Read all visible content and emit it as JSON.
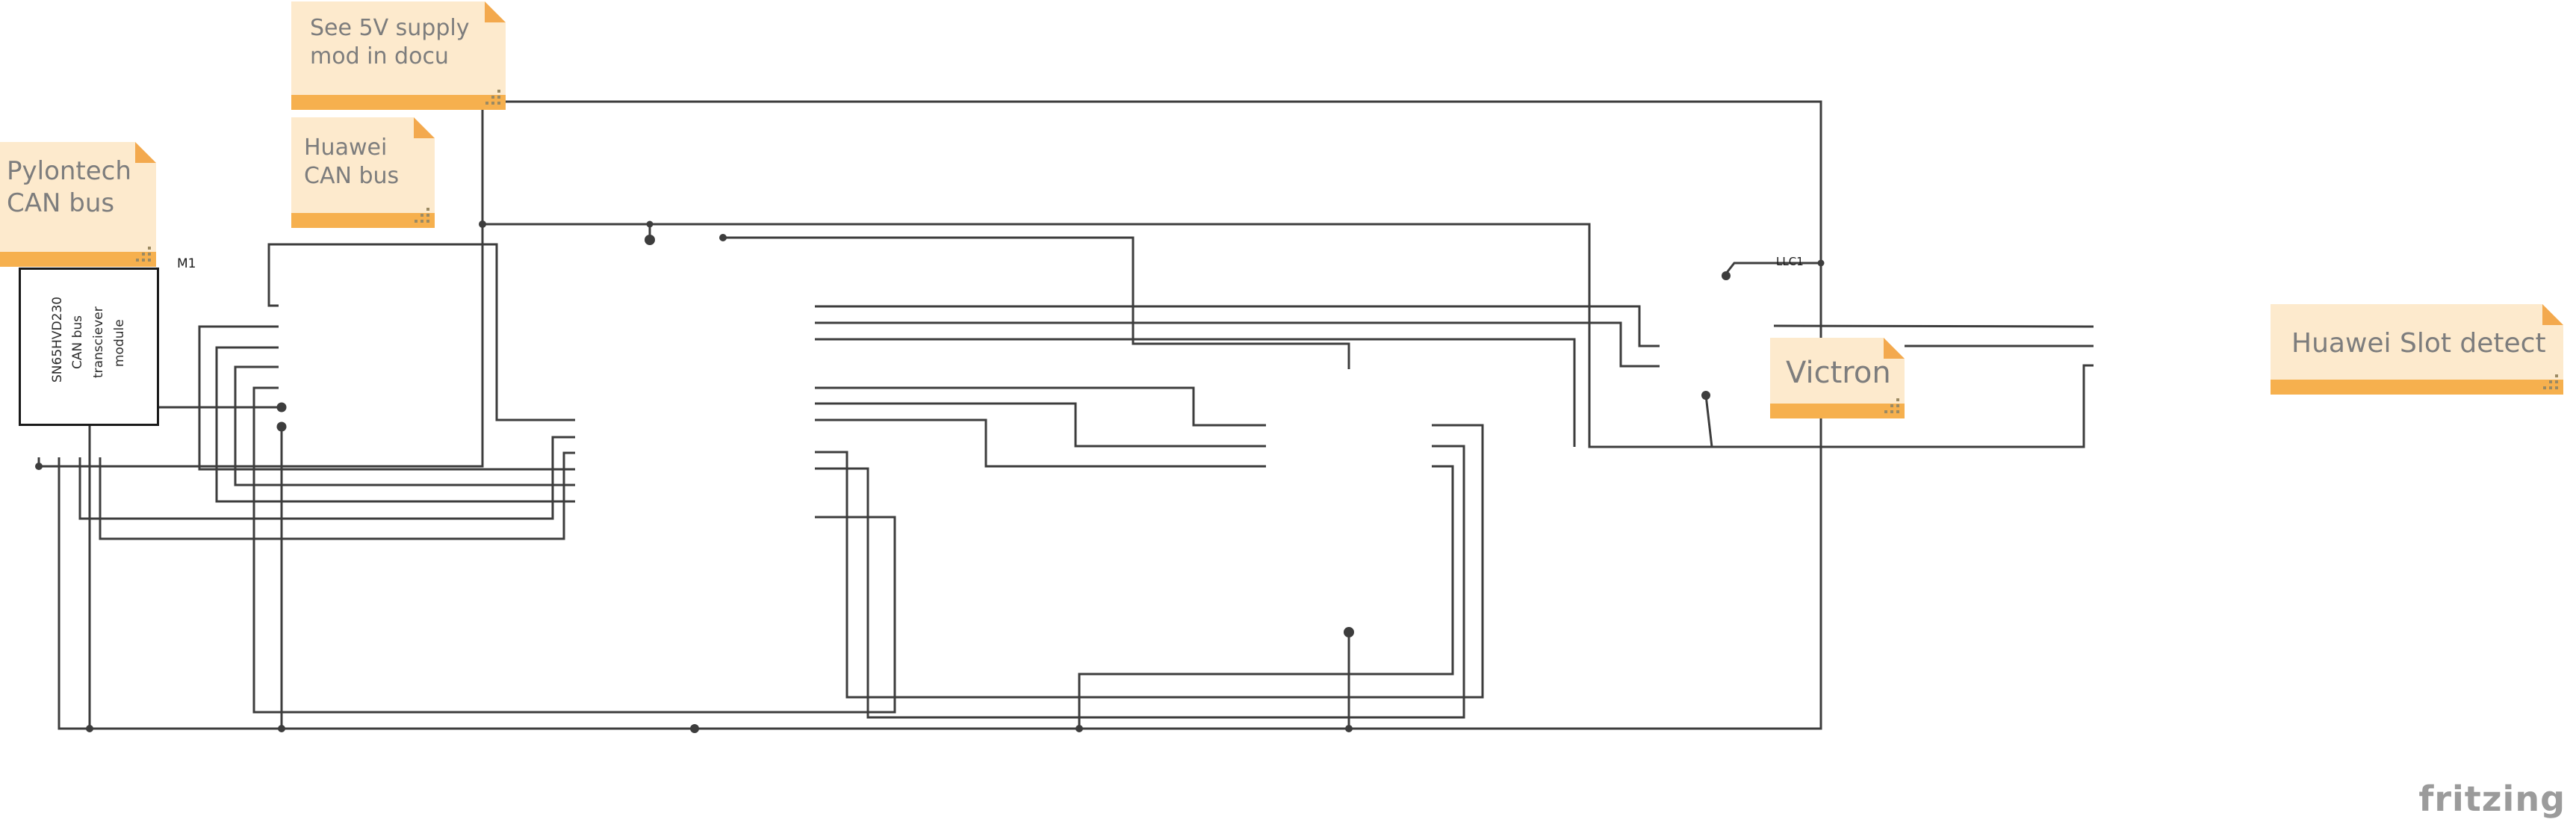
{
  "watermark": "fritzing",
  "colors": {
    "wire": "#3d3d3d",
    "pin_green": "#2db82d",
    "pin_green_glow": "#9fe49f",
    "pin_red": "#c03030",
    "pin_red_glow": "#f0a8a8",
    "note_body": "#fdeacd",
    "note_bar": "#f6b04e",
    "note_text": "#7d7d7d"
  },
  "notes": {
    "see5v": {
      "lines": [
        "See 5V supply",
        "mod in docu"
      ]
    },
    "pylontech": {
      "lines": [
        "Pylontech",
        "CAN bus"
      ]
    },
    "huawei_can": {
      "lines": [
        "Huawei",
        "CAN bus"
      ]
    },
    "victron": {
      "lines": [
        "Victron"
      ]
    },
    "huawei_slot": {
      "lines": [
        "Huawei Slot detect"
      ]
    }
  },
  "wire_labels": {
    "llc1_net": "LLC1"
  },
  "modules": {
    "m1": {
      "designator": "M1",
      "body_lines": [
        "SN65HVD230",
        "CAN bus",
        "transciever",
        "module"
      ],
      "bottom_pins": [
        {
          "n": "1",
          "label": "3V3",
          "color": "green"
        },
        {
          "n": "2",
          "label": "GND",
          "color": "green"
        },
        {
          "n": "3",
          "label": "CTX",
          "color": "green"
        },
        {
          "n": "4",
          "label": "CRX",
          "color": "green"
        },
        {
          "n": "5",
          "label": "CANH",
          "color": "red"
        },
        {
          "n": "6",
          "label": "CANL",
          "color": "red"
        }
      ]
    },
    "m2": {
      "designator": "M2",
      "vendor_lines": [
        "Niren",
        "MCP2515_CAN",
        "Module"
      ],
      "termination_lines": [
        "120 ohm",
        "termination"
      ],
      "jumpers": [
        "J1",
        "J2",
        "J4",
        "J3"
      ],
      "left_pins": [
        "INT",
        "SCK",
        "SI",
        "SO",
        "CS",
        "GND",
        "VCC"
      ],
      "right_pins": [
        "CAN H",
        "CAN L",
        "CAN H",
        "CAN L"
      ]
    },
    "u1": {
      "designator": "U1",
      "part": "ESP32-38PinWide",
      "body_lines": [
        "ESP32S",
        "HiLetgo",
        "WiFi",
        "Module"
      ],
      "top_pins": [
        "3.3V",
        "VIN 5V"
      ],
      "bottom_pin": "GND",
      "left_pins": [
        {
          "n": "2",
          "label": "EN/RESET",
          "color": "red"
        },
        {
          "n": "3",
          "label": "GPIO36/SVP",
          "color": "red"
        },
        {
          "n": "4",
          "label": "GPIO39/SVN",
          "color": "red"
        },
        {
          "n": "5",
          "label": "GPIO34",
          "color": "red"
        },
        {
          "n": "6",
          "label": "GPIO35",
          "color": "red"
        },
        {
          "n": "7",
          "label": "GPIO32",
          "color": "red"
        },
        {
          "n": "8",
          "label": "GPIO33",
          "color": "red"
        },
        {
          "n": "9",
          "label": "GPIO25",
          "color": "green"
        },
        {
          "n": "10",
          "label": "GPIO26",
          "color": "green"
        },
        {
          "n": "11",
          "label": "GPIO27",
          "color": "green"
        },
        {
          "n": "12",
          "label": "GPIO14",
          "color": "green"
        },
        {
          "n": "13",
          "label": "GPIO12",
          "color": "green"
        },
        {
          "n": "15",
          "label": "GPIO13",
          "color": "green"
        },
        {
          "n": "16",
          "label": "GPIO9/SD2",
          "color": "red"
        },
        {
          "n": "17",
          "label": "GPIO10/SD3",
          "color": "red"
        },
        {
          "n": "18",
          "label": "GPIO11/SDCMD",
          "color": "red"
        }
      ],
      "right_pins": [
        {
          "n": "37",
          "label": "GPIO23",
          "color": "green"
        },
        {
          "n": "36",
          "label": "GPIO22",
          "color": "green"
        },
        {
          "n": "35",
          "label": "GPIO1/TX0",
          "color": "green"
        },
        {
          "n": "34",
          "label": "GPIO3/RX0",
          "color": "red"
        },
        {
          "n": "33",
          "label": "GPIO21",
          "color": "red"
        },
        {
          "n": "31",
          "label": "GPIO19",
          "color": "green"
        },
        {
          "n": "30",
          "label": "GPIO18",
          "color": "green"
        },
        {
          "n": "29",
          "label": "GPIO5",
          "color": "green"
        },
        {
          "n": "28",
          "label": "GPIO17",
          "color": "red"
        },
        {
          "n": "27",
          "label": "GPIO16",
          "color": "green"
        },
        {
          "n": "26",
          "label": "GPIO4",
          "color": "green"
        },
        {
          "n": "25",
          "label": "GPIO0",
          "color": "red"
        },
        {
          "n": "24",
          "label": "GPIO2",
          "color": "red"
        },
        {
          "n": "23",
          "label": "GPIO15",
          "color": "green"
        },
        {
          "n": "22",
          "label": "GPIO8/SD1",
          "color": "red"
        },
        {
          "n": "21",
          "label": "GPIO7/SD0",
          "color": "red"
        },
        {
          "n": "20",
          "label": "GPIO6/SDCLK",
          "color": "red"
        }
      ]
    },
    "nrf": {
      "designator": "Bauteil1",
      "body_lines": [
        "NRF24L01+",
        "Breakout",
        "Board"
      ],
      "top_pin": {
        "n": "2",
        "label": "Vcc"
      },
      "bottom_pin": {
        "n": "1",
        "label": "Gnd"
      },
      "left_pins": [
        {
          "n": "3",
          "label": "CE"
        },
        {
          "n": "5",
          "label": "SCK"
        },
        {
          "n": "7",
          "label": "MISO"
        }
      ],
      "right_pins": [
        {
          "n": "4",
          "label": "CS"
        },
        {
          "n": "6",
          "label": "MOSI"
        },
        {
          "n": "8",
          "label": "IRQ"
        }
      ]
    },
    "llc": {
      "designator": "LLC1",
      "body_lines": [
        "LLC",
        "5V-3.3V"
      ]
    },
    "m3": {
      "designator": "M3",
      "body_lines": [
        "Module",
        "5V Relay",
        "1 Channel"
      ],
      "left_pins": [
        {
          "n": "3",
          "label": "IN"
        },
        {
          "n": "2",
          "label": "DC-"
        },
        {
          "n": "1",
          "label": "DC+"
        }
      ],
      "right_pins": [
        {
          "n": "4",
          "label": "NO"
        },
        {
          "n": "5",
          "label": "COM"
        },
        {
          "n": "6",
          "label": "NC"
        }
      ]
    }
  }
}
